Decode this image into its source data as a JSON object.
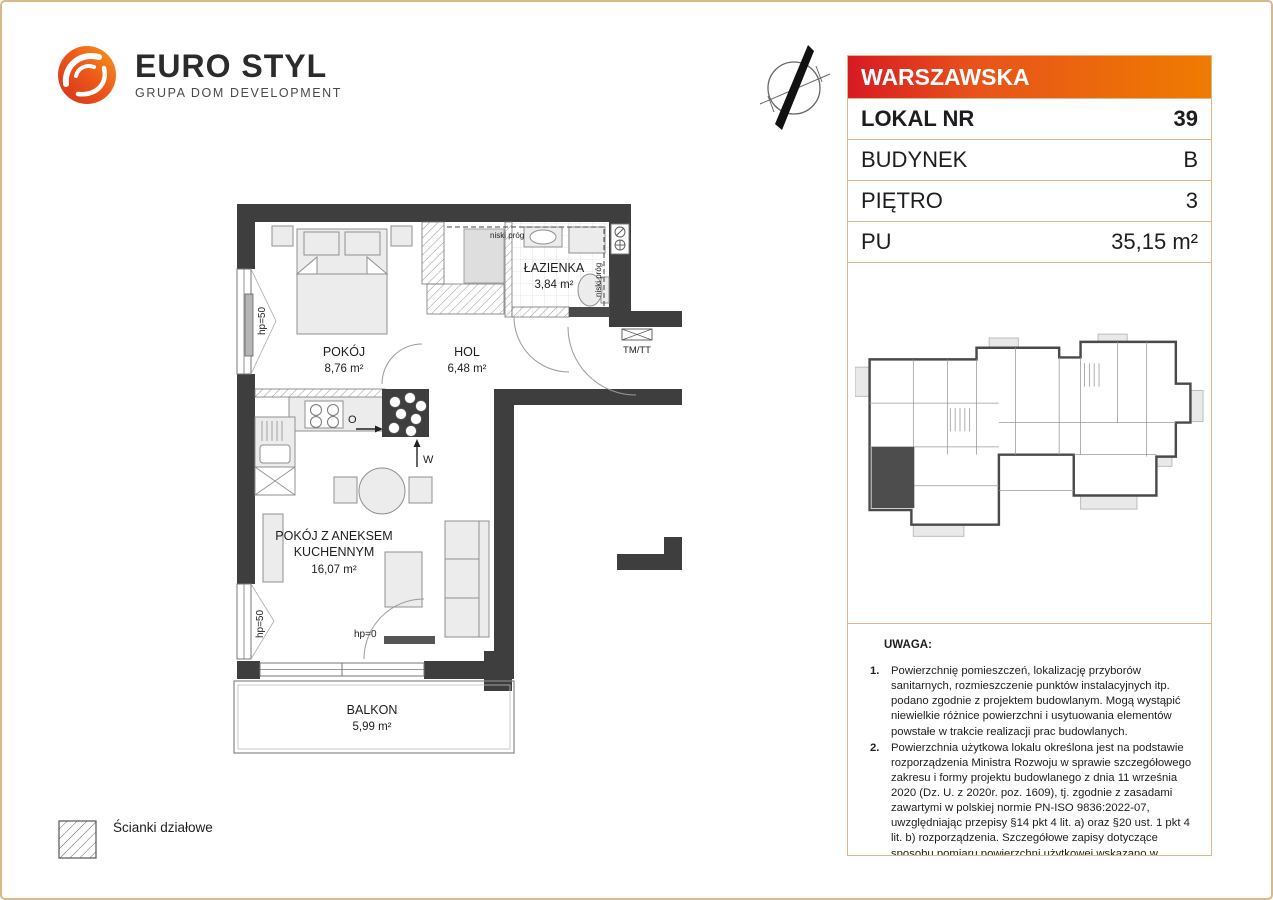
{
  "logo": {
    "title": "EURO STYL",
    "subtitle": "GRUPA DOM DEVELOPMENT"
  },
  "info_table": {
    "header": "WARSZAWSKA",
    "rows": [
      {
        "label": "LOKAL NR",
        "value": "39"
      },
      {
        "label": "BUDYNEK",
        "value": "B"
      },
      {
        "label": "PIĘTRO",
        "value": "3"
      },
      {
        "label": "PU",
        "value": "35,15 m²"
      }
    ]
  },
  "plan": {
    "rooms": {
      "pokoj": {
        "name": "POKÓJ",
        "area": "8,76 m²"
      },
      "hol": {
        "name": "HOL",
        "area": "6,48 m²"
      },
      "lazienka": {
        "name": "ŁAZIENKA",
        "area": "3,84 m²"
      },
      "aneks": {
        "name1": "POKÓJ Z ANEKSEM",
        "name2": "KUCHENNYM",
        "area": "16,07 m²"
      },
      "balkon": {
        "name": "BALKON",
        "area": "5,99 m²"
      }
    },
    "labels": {
      "niski_prog": "niski próg",
      "tm_tt": "TM/TT",
      "hp50": "hp=50",
      "hp0": "hp=0",
      "vent_w": "W",
      "vent_o": "O"
    }
  },
  "legend": {
    "partition_walls": "Ścianki działowe"
  },
  "notes": {
    "heading": "UWAGA:",
    "items": [
      {
        "num": "1.",
        "text": "Powierzchnię pomieszczeń, lokalizację przyborów sanitarnych, rozmieszczenie punktów instalacyjnych itp. podano zgodnie z projektem budowlanym. Mogą wystąpić niewielkie różnice powierzchni i usytuowania elementów powstałe w trakcie realizacji prac budowlanych."
      },
      {
        "num": "2.",
        "text": "Powierzchnia użytkowa lokalu określona jest na podstawie rozporządzenia Ministra Rozwoju w sprawie szczegółowego zakresu i formy projektu budowlanego z dnia 11 września 2020 (Dz. U. z 2020r. poz. 1609), tj. zgodnie z zasadami zawartymi w polskiej normie PN-ISO 9836:2022-07, uwzględniając przepisy §14 pkt 4 lit. a) oraz §20 ust. 1 pkt 4 lit. b) rozporządzenia. Szczegółowe zapisy dotyczące sposobu pomiaru powierzchni użytkowej wskazano w umowie."
      },
      {
        "num": "3.",
        "text": "Przedstawiona na rzucie aranżacja ma charakter przykładowy, umeblowanie i zabudowy instalacyjne nie stanowią wyposażenia nabywanego lokalu"
      }
    ]
  },
  "colors": {
    "accent_red": "#d71a23",
    "accent_orange": "#ef7c00",
    "border_tan": "#dcb98a",
    "wall": "#3e3e3e",
    "furniture": "#ececec"
  }
}
